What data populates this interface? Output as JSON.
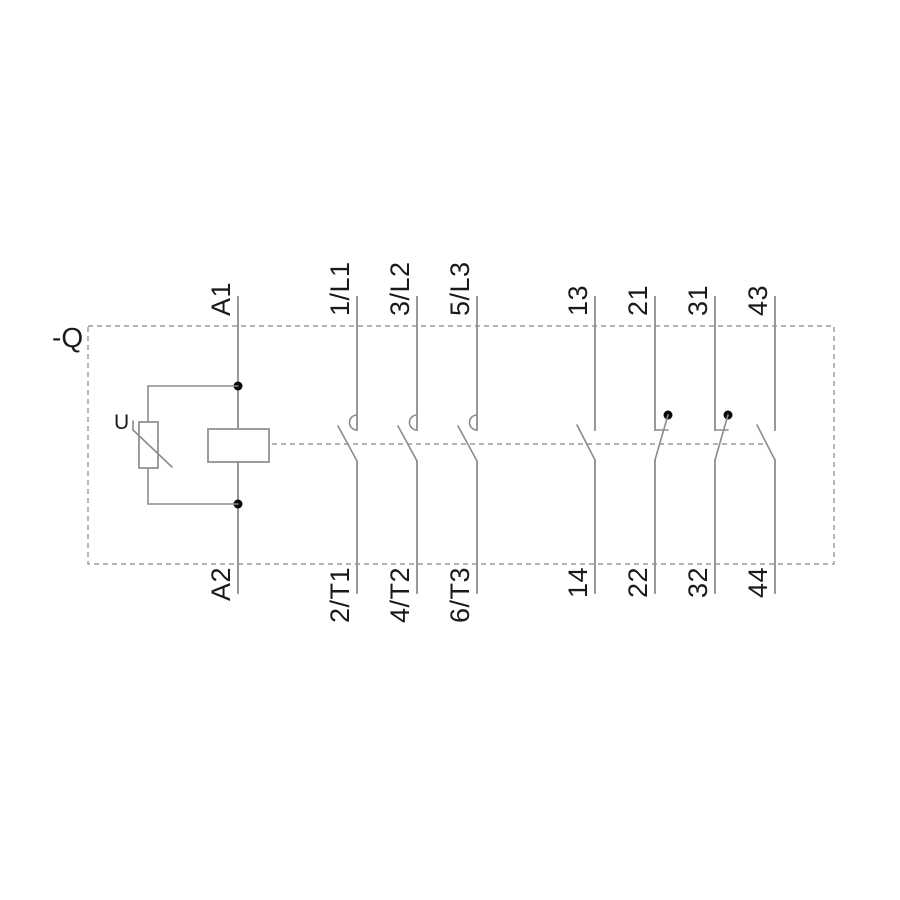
{
  "device": {
    "reference": "-Q",
    "kind": "contactor-schematic"
  },
  "coil": {
    "terminal_top": "A1",
    "terminal_bottom": "A2",
    "suppressor_label": "U"
  },
  "main_poles": [
    {
      "terminal_top": "1/L1",
      "terminal_bottom": "2/T1"
    },
    {
      "terminal_top": "3/L2",
      "terminal_bottom": "4/T2"
    },
    {
      "terminal_top": "5/L3",
      "terminal_bottom": "6/T3"
    }
  ],
  "aux_contacts": [
    {
      "terminal_top": "13",
      "terminal_bottom": "14",
      "type": "NO"
    },
    {
      "terminal_top": "21",
      "terminal_bottom": "22",
      "type": "NC"
    },
    {
      "terminal_top": "31",
      "terminal_bottom": "32",
      "type": "NC"
    },
    {
      "terminal_top": "43",
      "terminal_bottom": "44",
      "type": "NO"
    }
  ],
  "colors": {
    "line": "#8c8c8c",
    "dash": "#9a9a9a",
    "text": "#1a1a1a",
    "dot": "#0a0a0a",
    "background": "#ffffff"
  }
}
